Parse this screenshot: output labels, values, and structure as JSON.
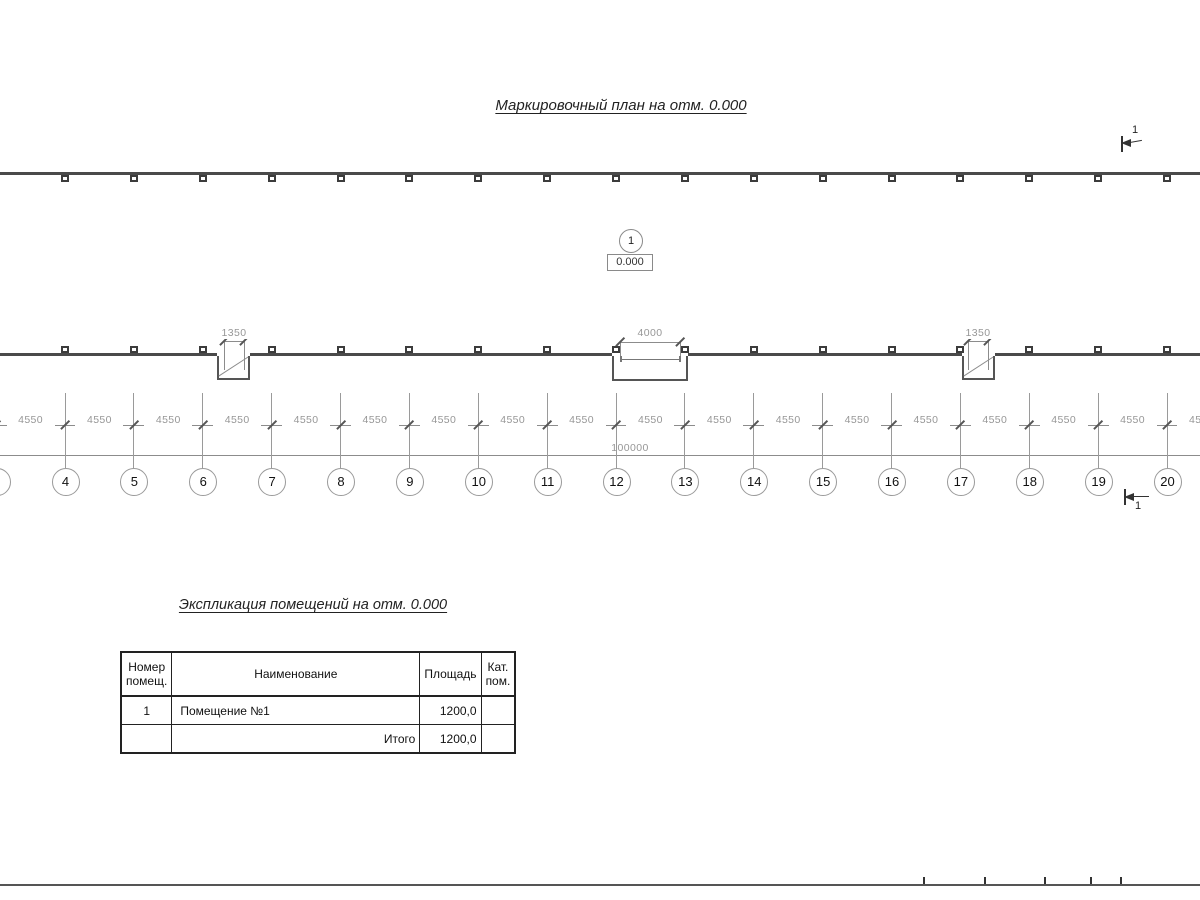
{
  "plan": {
    "title": "Маркировочный план на отм. 0.000",
    "section_marker_top": {
      "label": "1"
    },
    "section_marker_bottom": {
      "label": "1"
    },
    "room_marker": {
      "number": "1",
      "elevation": "0.000"
    },
    "openings": [
      {
        "width_label": "1350"
      },
      {
        "width_label": "4000"
      },
      {
        "width_label": "1350"
      }
    ],
    "bay_dim_label": "4550",
    "total_dim_label": "100000",
    "grid_numbers": [
      "3",
      "4",
      "5",
      "6",
      "7",
      "8",
      "9",
      "10",
      "11",
      "12",
      "13",
      "14",
      "15",
      "16",
      "17",
      "18",
      "19",
      "20"
    ]
  },
  "schedule": {
    "title": "Экспликация помещений на отм. 0.000",
    "headers": {
      "number_line1": "Номер",
      "number_line2": "помещ.",
      "name": "Наименование",
      "area": "Площадь",
      "cat_line1": "Кат.",
      "cat_line2": "пом."
    },
    "rows": [
      {
        "number": "1",
        "name": "Помещение №1",
        "area": "1200,0",
        "cat": ""
      }
    ],
    "total_label": "Итого",
    "total_area": "1200,0",
    "total_cat": ""
  },
  "colors": {
    "wall": "#4a4a4a",
    "thin_line": "#8c8c8c",
    "dim_text": "#979797",
    "table_border": "#222222",
    "text": "#1a1a1a"
  }
}
